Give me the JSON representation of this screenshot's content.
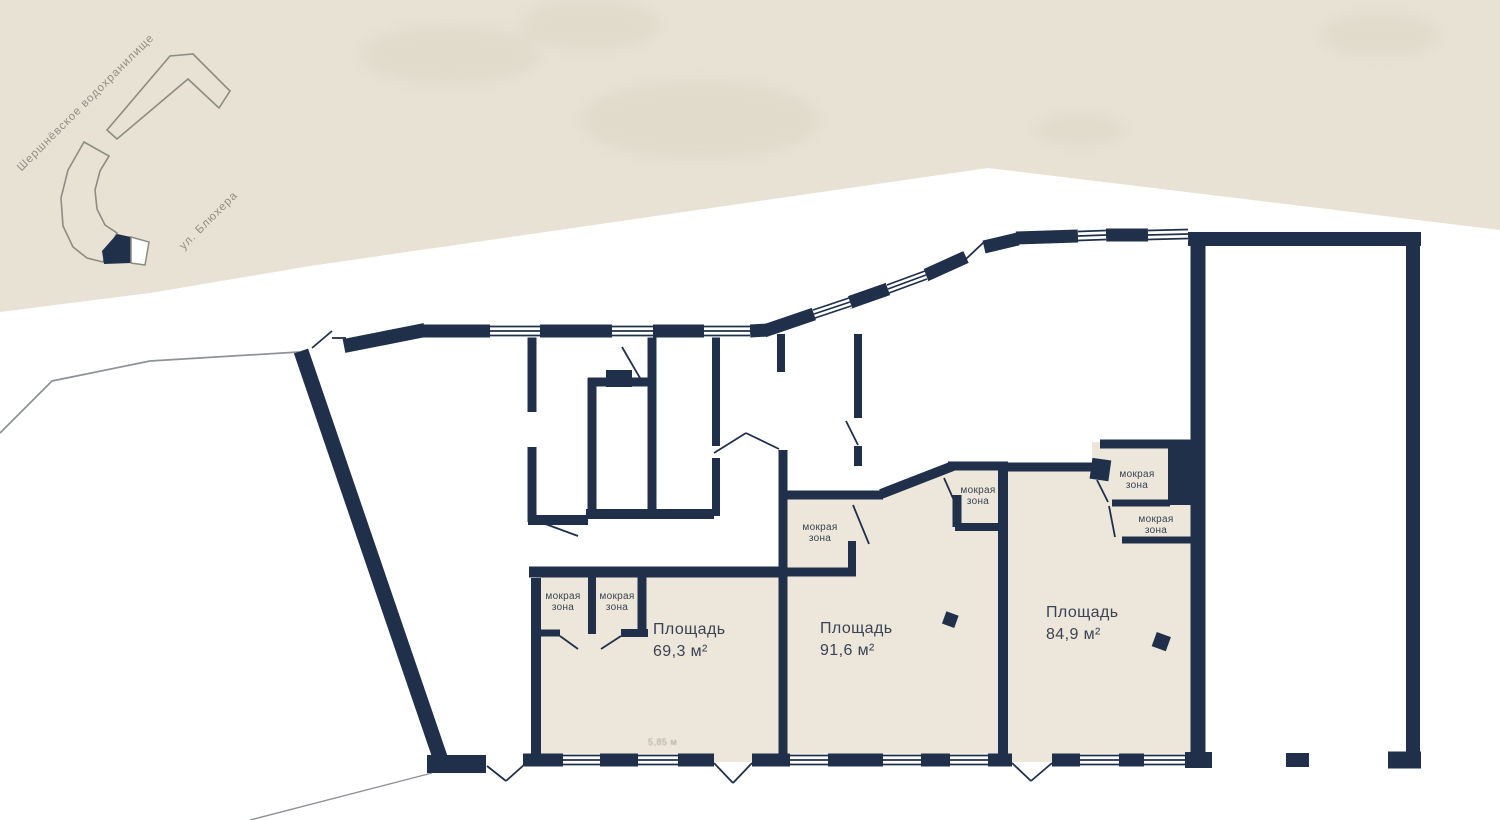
{
  "map": {
    "reservoir_label": "Шершнёвское водохранилище",
    "street_label": "ул. Блюхера"
  },
  "rooms": [
    {
      "label": "Площадь",
      "area": "69,3 м²"
    },
    {
      "label": "Площадь",
      "area": "91,6 м²"
    },
    {
      "label": "Площадь",
      "area": "84,9 м²"
    }
  ],
  "wet": {
    "line1": "мокрая",
    "line2": "зона"
  },
  "faint_dimension": "5,85 м",
  "colors": {
    "wall": "#20304a",
    "land": "#e7e2d4",
    "blotch": "#d9d3c2",
    "room": "#ece7da",
    "mapline": "#8d8c82",
    "road": "#8f9297",
    "text": "#3a4353",
    "maptext": "#908e85"
  }
}
